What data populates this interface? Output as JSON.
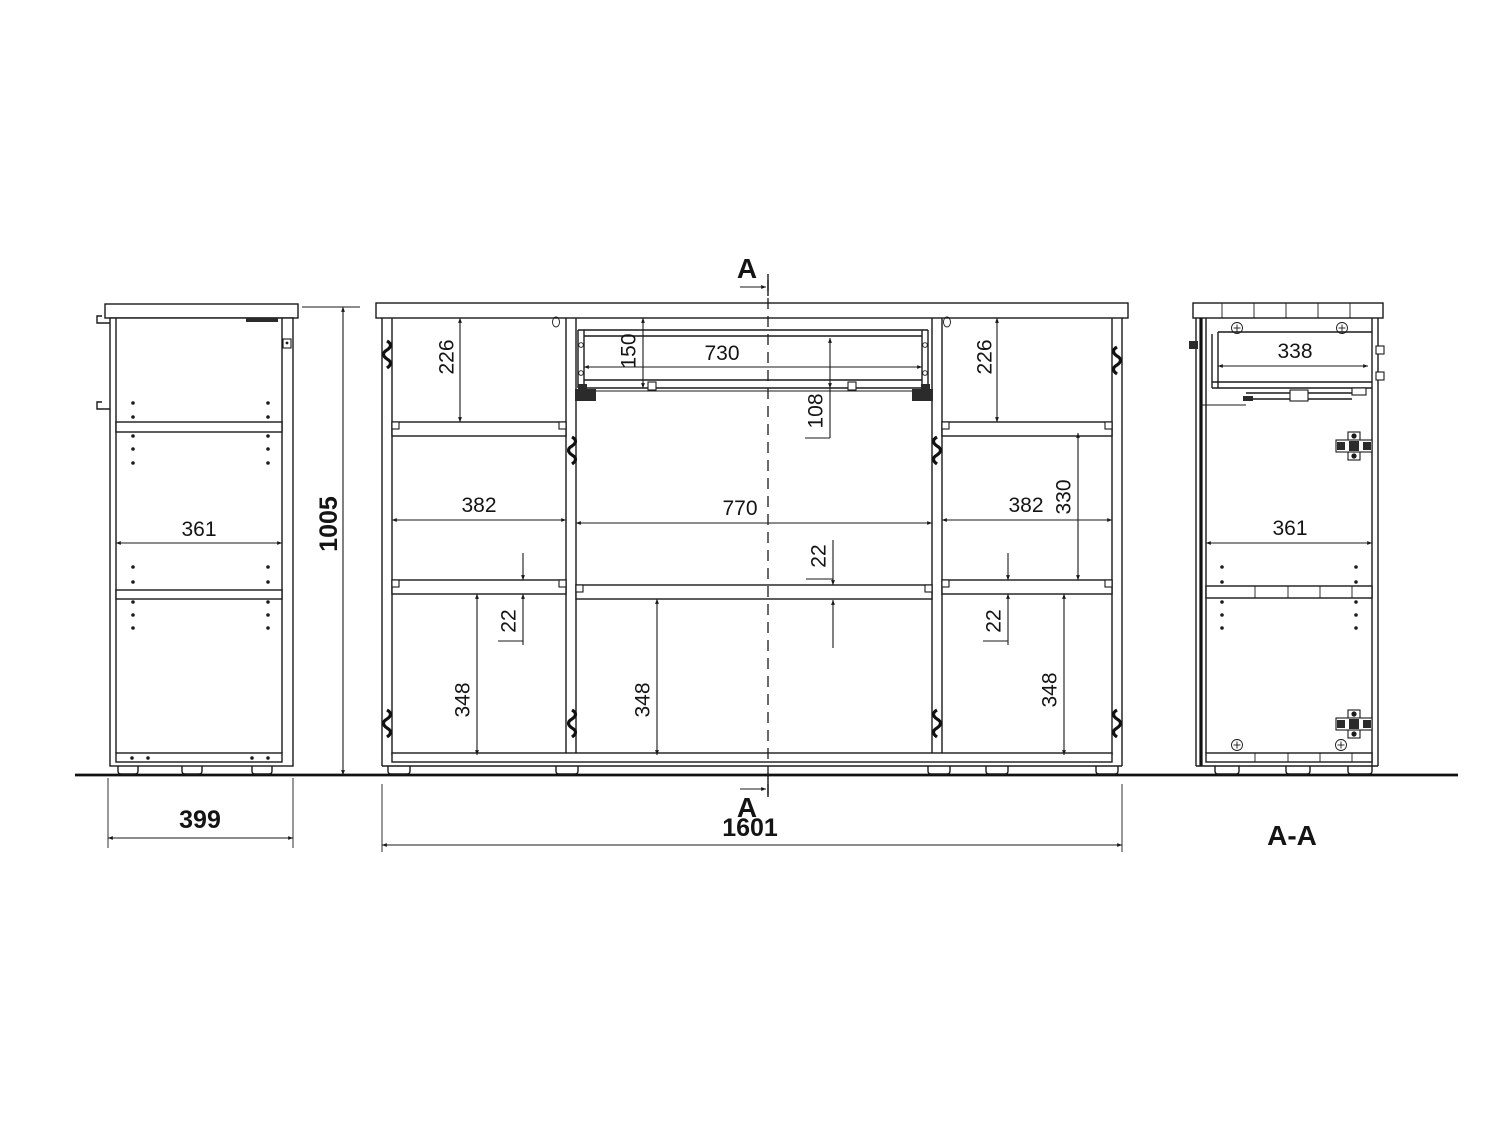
{
  "page": {
    "background": "#ffffff",
    "line_color": "#1a1a1a"
  },
  "section_labels": {
    "top": "A",
    "bottom": "A",
    "title": "A-A"
  },
  "dimensions": {
    "side_view": {
      "inner_width": "361",
      "height": "1005",
      "depth": "399"
    },
    "front_view": {
      "top_left_height": "226",
      "drawer_front_height": "150",
      "drawer_width": "730",
      "drawer_side_height": "108",
      "top_right_height": "226",
      "mid_left_width": "382",
      "mid_center_width": "770",
      "mid_right_width": "382",
      "mid_right_height": "330",
      "shelf_thickness_left": "22",
      "shelf_thickness_center": "22",
      "shelf_thickness_right": "22",
      "bottom_left_height": "348",
      "bottom_center_height": "348",
      "bottom_right_height": "348",
      "total_width": "1601"
    },
    "section_view": {
      "drawer_depth": "338",
      "inner_width": "361"
    }
  }
}
